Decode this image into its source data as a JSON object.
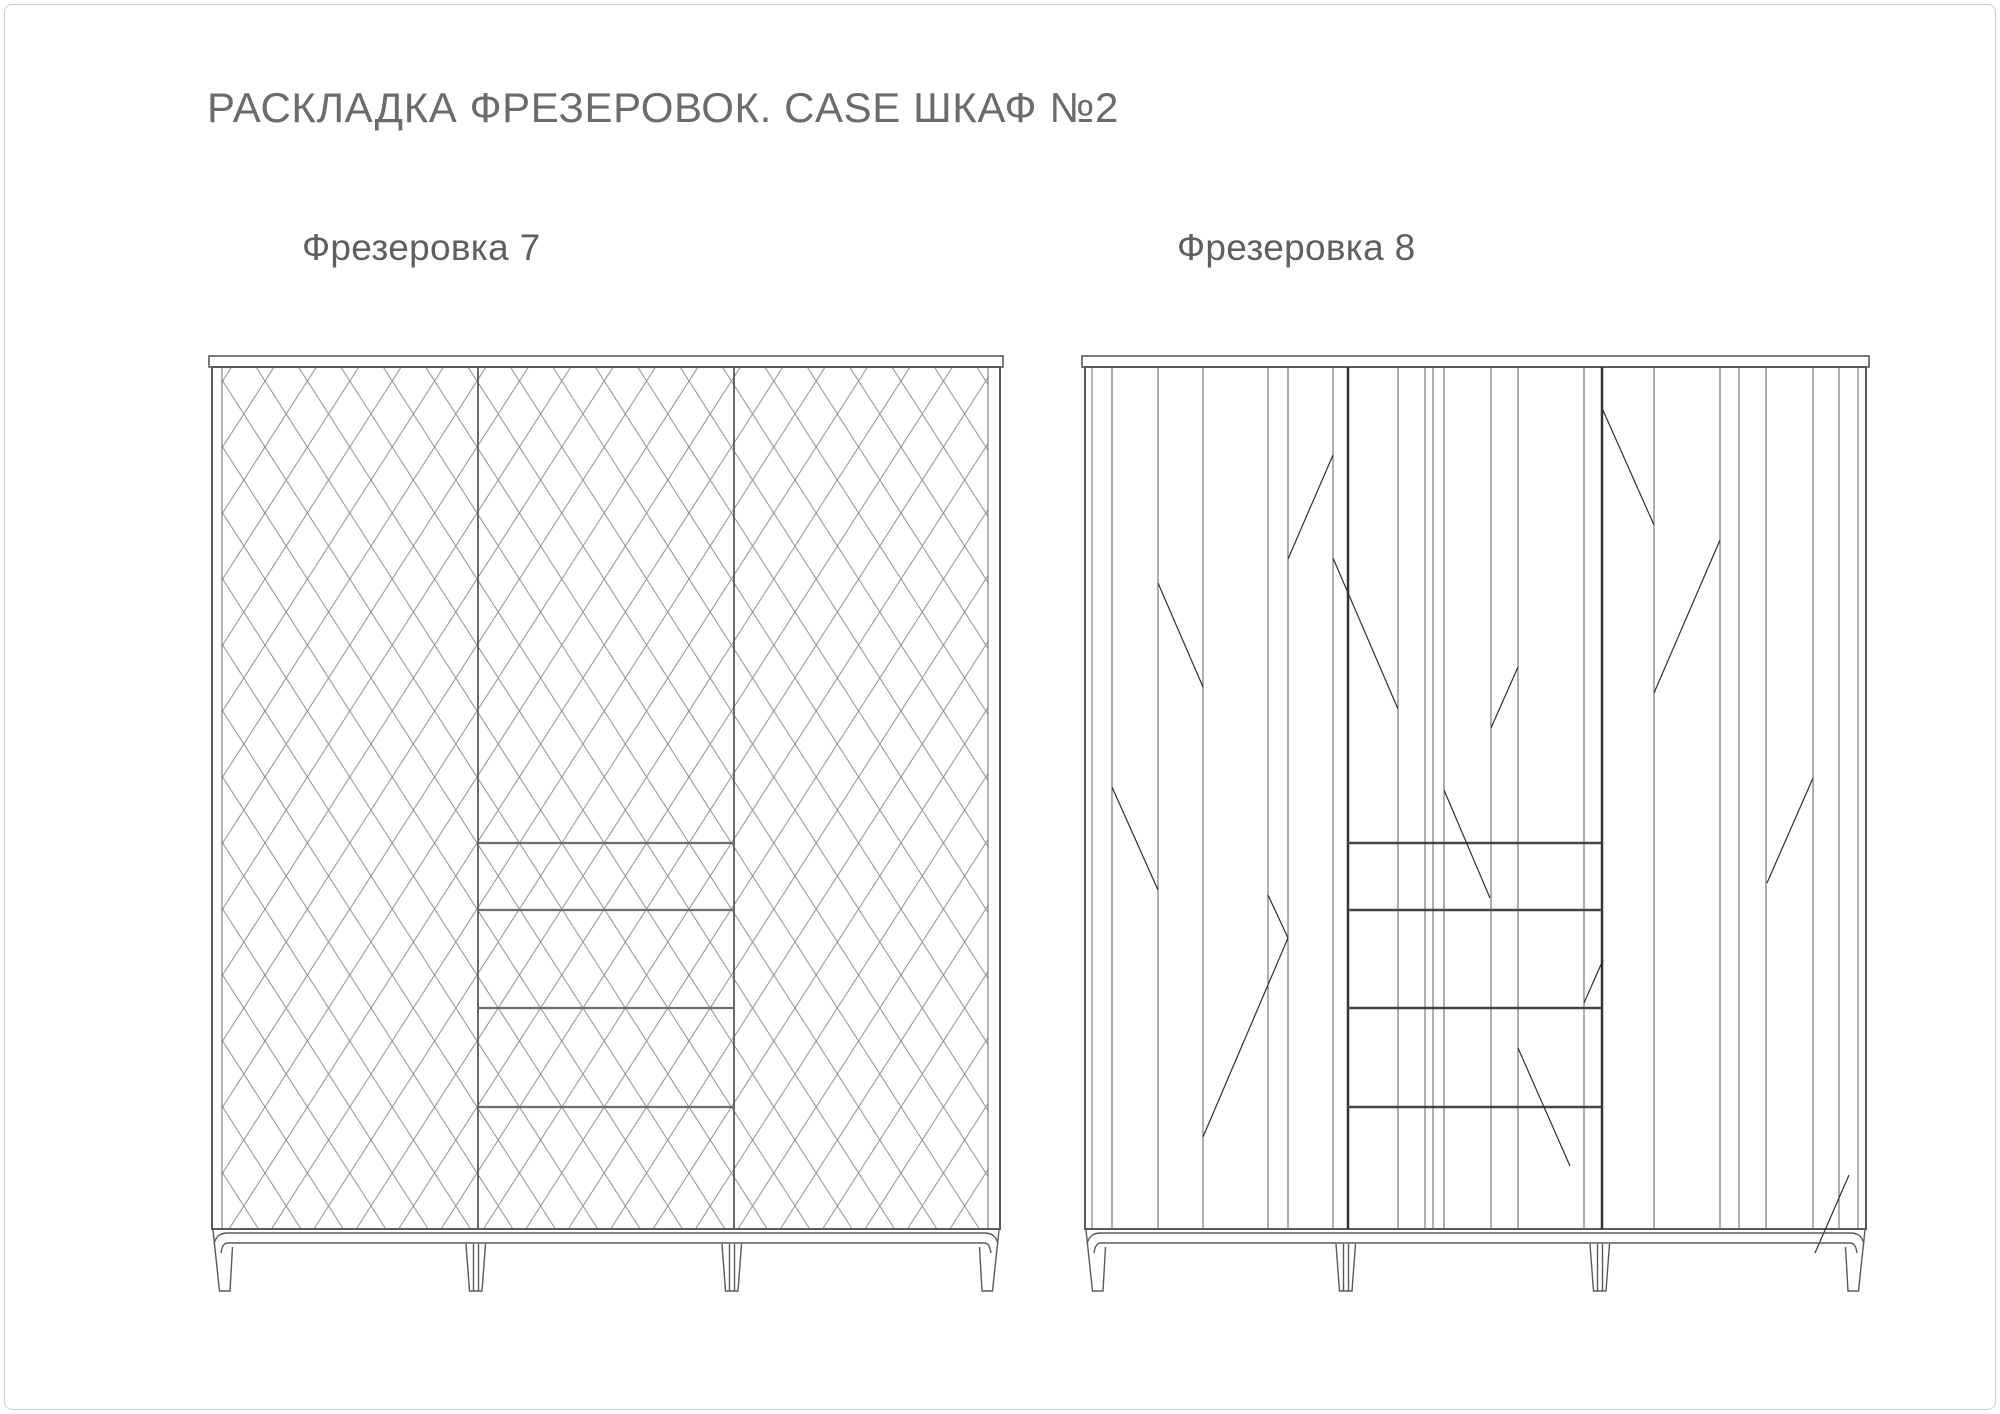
{
  "page": {
    "title": "РАСКЛАДКА ФРЕЗЕРОВОК. CASE ШКАФ №2"
  },
  "drawings": [
    {
      "label": "Фрезеровка 7",
      "pattern": "diamond-lattice",
      "door_sections": 3,
      "drawer_lines": 4
    },
    {
      "label": "Фрезеровка 8",
      "pattern": "vertical-planks-with-diagonal-accents",
      "door_sections": 3,
      "drawer_lines": 4
    }
  ],
  "colors": {
    "background": "#ffffff",
    "page_border": "#cbcbcb",
    "title": "#6b6b6b",
    "label": "#5f5f5f",
    "frame": "#5a5a5a",
    "stile": "#6a6a6a",
    "lattice": "#8c8c8c",
    "plank": "#5f5f5f",
    "divider": "#333333",
    "drawer_left": "#6e6e6e",
    "drawer_right": "#454545",
    "diagonal": "#303030",
    "base": "#5a5a5a"
  }
}
